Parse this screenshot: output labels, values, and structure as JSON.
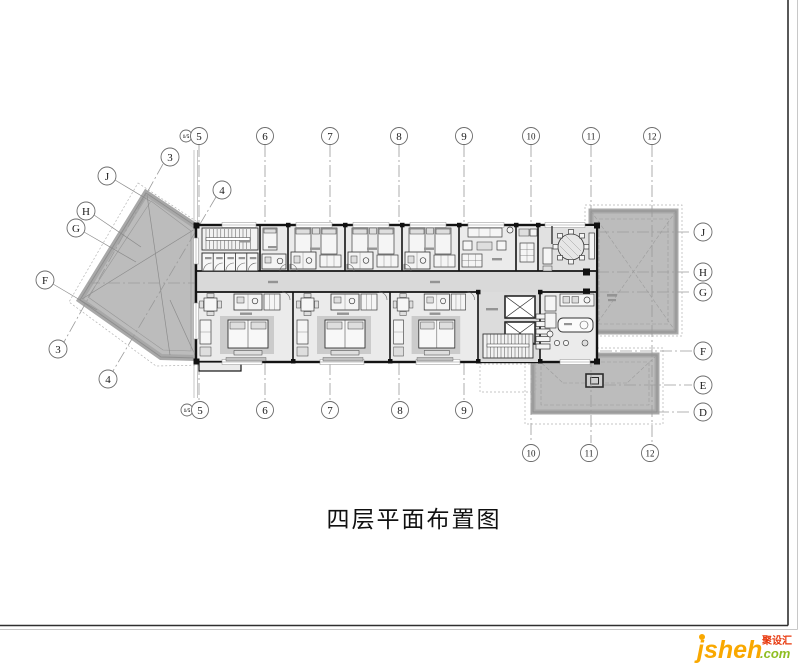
{
  "drawing": {
    "title": "四层平面布置图"
  },
  "grid": {
    "sub_axis_marker": "1/5",
    "top_axes": [
      "5",
      "6",
      "7",
      "8",
      "9",
      "10",
      "11",
      "12"
    ],
    "bottom_axes": [
      "5",
      "6",
      "7",
      "8",
      "9",
      "10",
      "11",
      "12"
    ],
    "left_axes": [
      "3",
      "4",
      "J",
      "H",
      "G",
      "F",
      "3",
      "4"
    ],
    "right_axes": [
      "J",
      "H",
      "G",
      "F",
      "E",
      "D"
    ]
  },
  "watermark": {
    "logo_text": "jsheh",
    "suffix_text": ".com",
    "badge_text": "聚设汇"
  },
  "palette": {
    "roof": "#bcbcbc",
    "wall": "#141414",
    "axis": "#9a9a9a",
    "floor": "#ebebeb",
    "corridor": "#d9d9d9",
    "logo_orange": "#f9a800",
    "logo_green": "#8fbe22",
    "badge_red": "#e8380d"
  }
}
